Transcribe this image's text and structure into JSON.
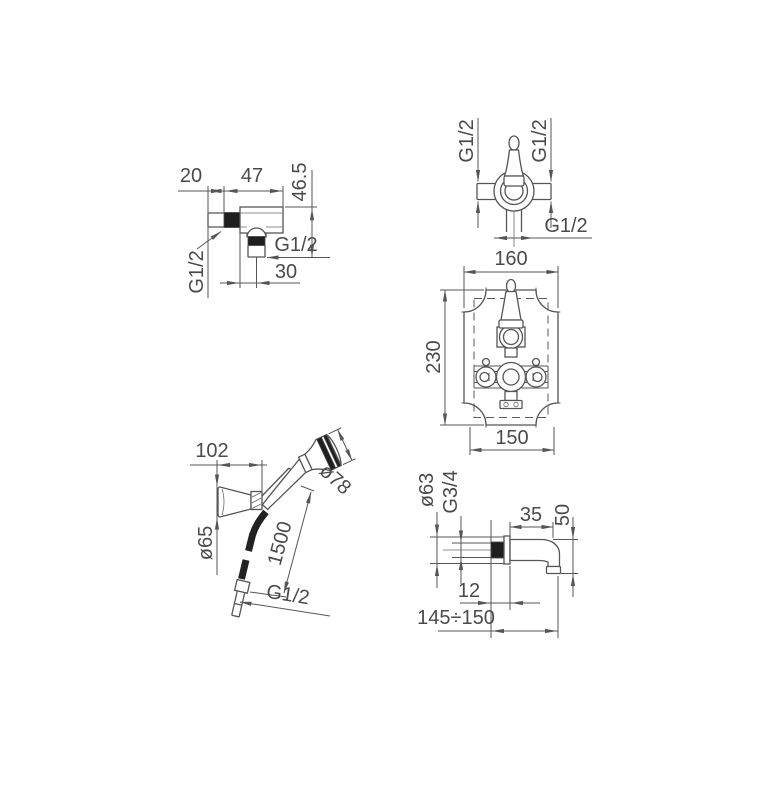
{
  "page": {
    "background": "#ffffff",
    "line_color": "#555555",
    "text_color": "#4a4a4a",
    "solid_fill_color": "#1f1f1f"
  },
  "drawings": {
    "wall_elbow": {
      "title": "wall-outlet-elbow",
      "labels": {
        "offset": "20",
        "body_width": "47",
        "height": "46.5",
        "outlet_thread": "G1/2",
        "outlet_distance": "30",
        "inlet_thread": "G1/2"
      }
    },
    "stop_valve": {
      "title": "concealed-stop-valve",
      "labels": {
        "left_thread": "G1/2",
        "right_thread": "G1/2",
        "bottom_thread": "G1/2"
      }
    },
    "thermostat_plate": {
      "title": "concealed-thermostat-trim-plate",
      "labels": {
        "plate_width": "160",
        "plate_height": "230",
        "fixing_width": "150"
      }
    },
    "hand_shower": {
      "title": "hand-shower-with-bracket-and-hose",
      "labels": {
        "bracket_projection": "102",
        "head_diameter": "ø78",
        "bracket_diameter": "ø65",
        "hose_length": "1500",
        "hose_thread": "G1/2"
      }
    },
    "bath_spout": {
      "title": "wall-mounted-bath-spout",
      "labels": {
        "flange_diameter": "ø63",
        "connection_thread": "G3/4",
        "top_length": "35",
        "drop": "50",
        "wall_inset": "12",
        "reach": "145÷150"
      }
    }
  }
}
